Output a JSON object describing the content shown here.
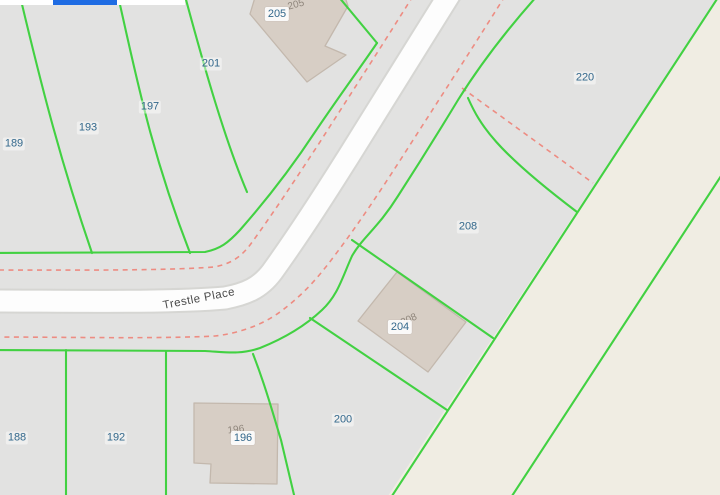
{
  "map": {
    "road_name": "Trestle Place",
    "road_label": {
      "x": 199,
      "y": 299,
      "rotation": -11
    },
    "parcel_labels": [
      {
        "text": "189",
        "x": 14,
        "y": 144
      },
      {
        "text": "193",
        "x": 88,
        "y": 128
      },
      {
        "text": "197",
        "x": 150,
        "y": 107
      },
      {
        "text": "201",
        "x": 211,
        "y": 64
      },
      {
        "text": "220",
        "x": 585,
        "y": 78
      },
      {
        "text": "208",
        "x": 468,
        "y": 227
      },
      {
        "text": "200",
        "x": 343,
        "y": 420
      },
      {
        "text": "192",
        "x": 116,
        "y": 438
      },
      {
        "text": "188",
        "x": 17,
        "y": 438
      }
    ],
    "parcel_pill_labels": [
      {
        "text": "205",
        "x": 277,
        "y": 14
      },
      {
        "text": "204",
        "x": 400,
        "y": 327
      },
      {
        "text": "196",
        "x": 243,
        "y": 438
      }
    ],
    "address_labels": [
      {
        "text": "205",
        "x": 296,
        "y": 5,
        "rotation": -15
      },
      {
        "text": "208",
        "x": 409,
        "y": 320,
        "rotation": -24
      },
      {
        "text": "196",
        "x": 236,
        "y": 430,
        "rotation": -7
      }
    ],
    "colors": {
      "parcel_fill": "#e2e2e1",
      "terrain_fill": "#f0ede3",
      "road_fill": "#fdfdfd",
      "road_casing": "#d6d6d3",
      "building_fill": "#d7cec5",
      "building_stroke": "#c3b8ad",
      "parcel_line": "#42d142",
      "easement_line": "#ef8378",
      "label_blue": "#33688c",
      "address_gray": "#8f867c",
      "road_text": "#4a4a4a",
      "toolbar_blue": "#1f6ce3"
    }
  }
}
